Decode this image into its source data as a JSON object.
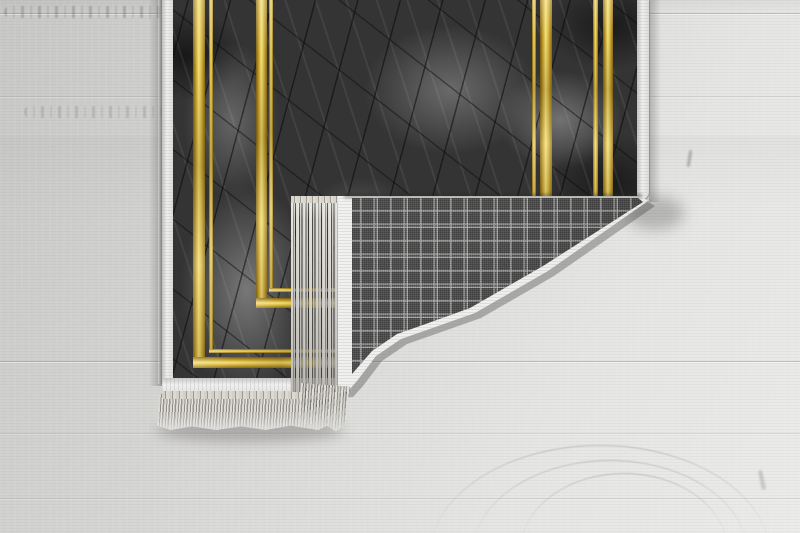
{
  "scene": {
    "type": "product-photo",
    "subject": "rug with folded corner",
    "parts": {
      "floor": "light gray wood floor",
      "rug_front": "dark gray marble patterned rug face",
      "gold_frame": "double gold line rectangular frames",
      "binding": "white fabric edge binding",
      "fold_back": "gray tartan plaid woven rug backing",
      "fringe": "cream tassel fringe",
      "shadow": "soft cast shadow"
    }
  },
  "colors": {
    "floor_light": "#e6e6e4",
    "floor_mid": "#d6d6d4",
    "floor_dark": "#c7c7c5",
    "marble_base": "#343434",
    "marble_light": "#9a9a9a",
    "gold_light": "#f2e07e",
    "gold_mid": "#c9a52e",
    "gold_dark": "#7a5c10",
    "plaid_base": "#5c5c5c",
    "plaid_line": "#cdcdcb",
    "binding_white": "#efefed",
    "fringe_cream": "#dbd8d0",
    "shadow": "#3a3a38"
  }
}
